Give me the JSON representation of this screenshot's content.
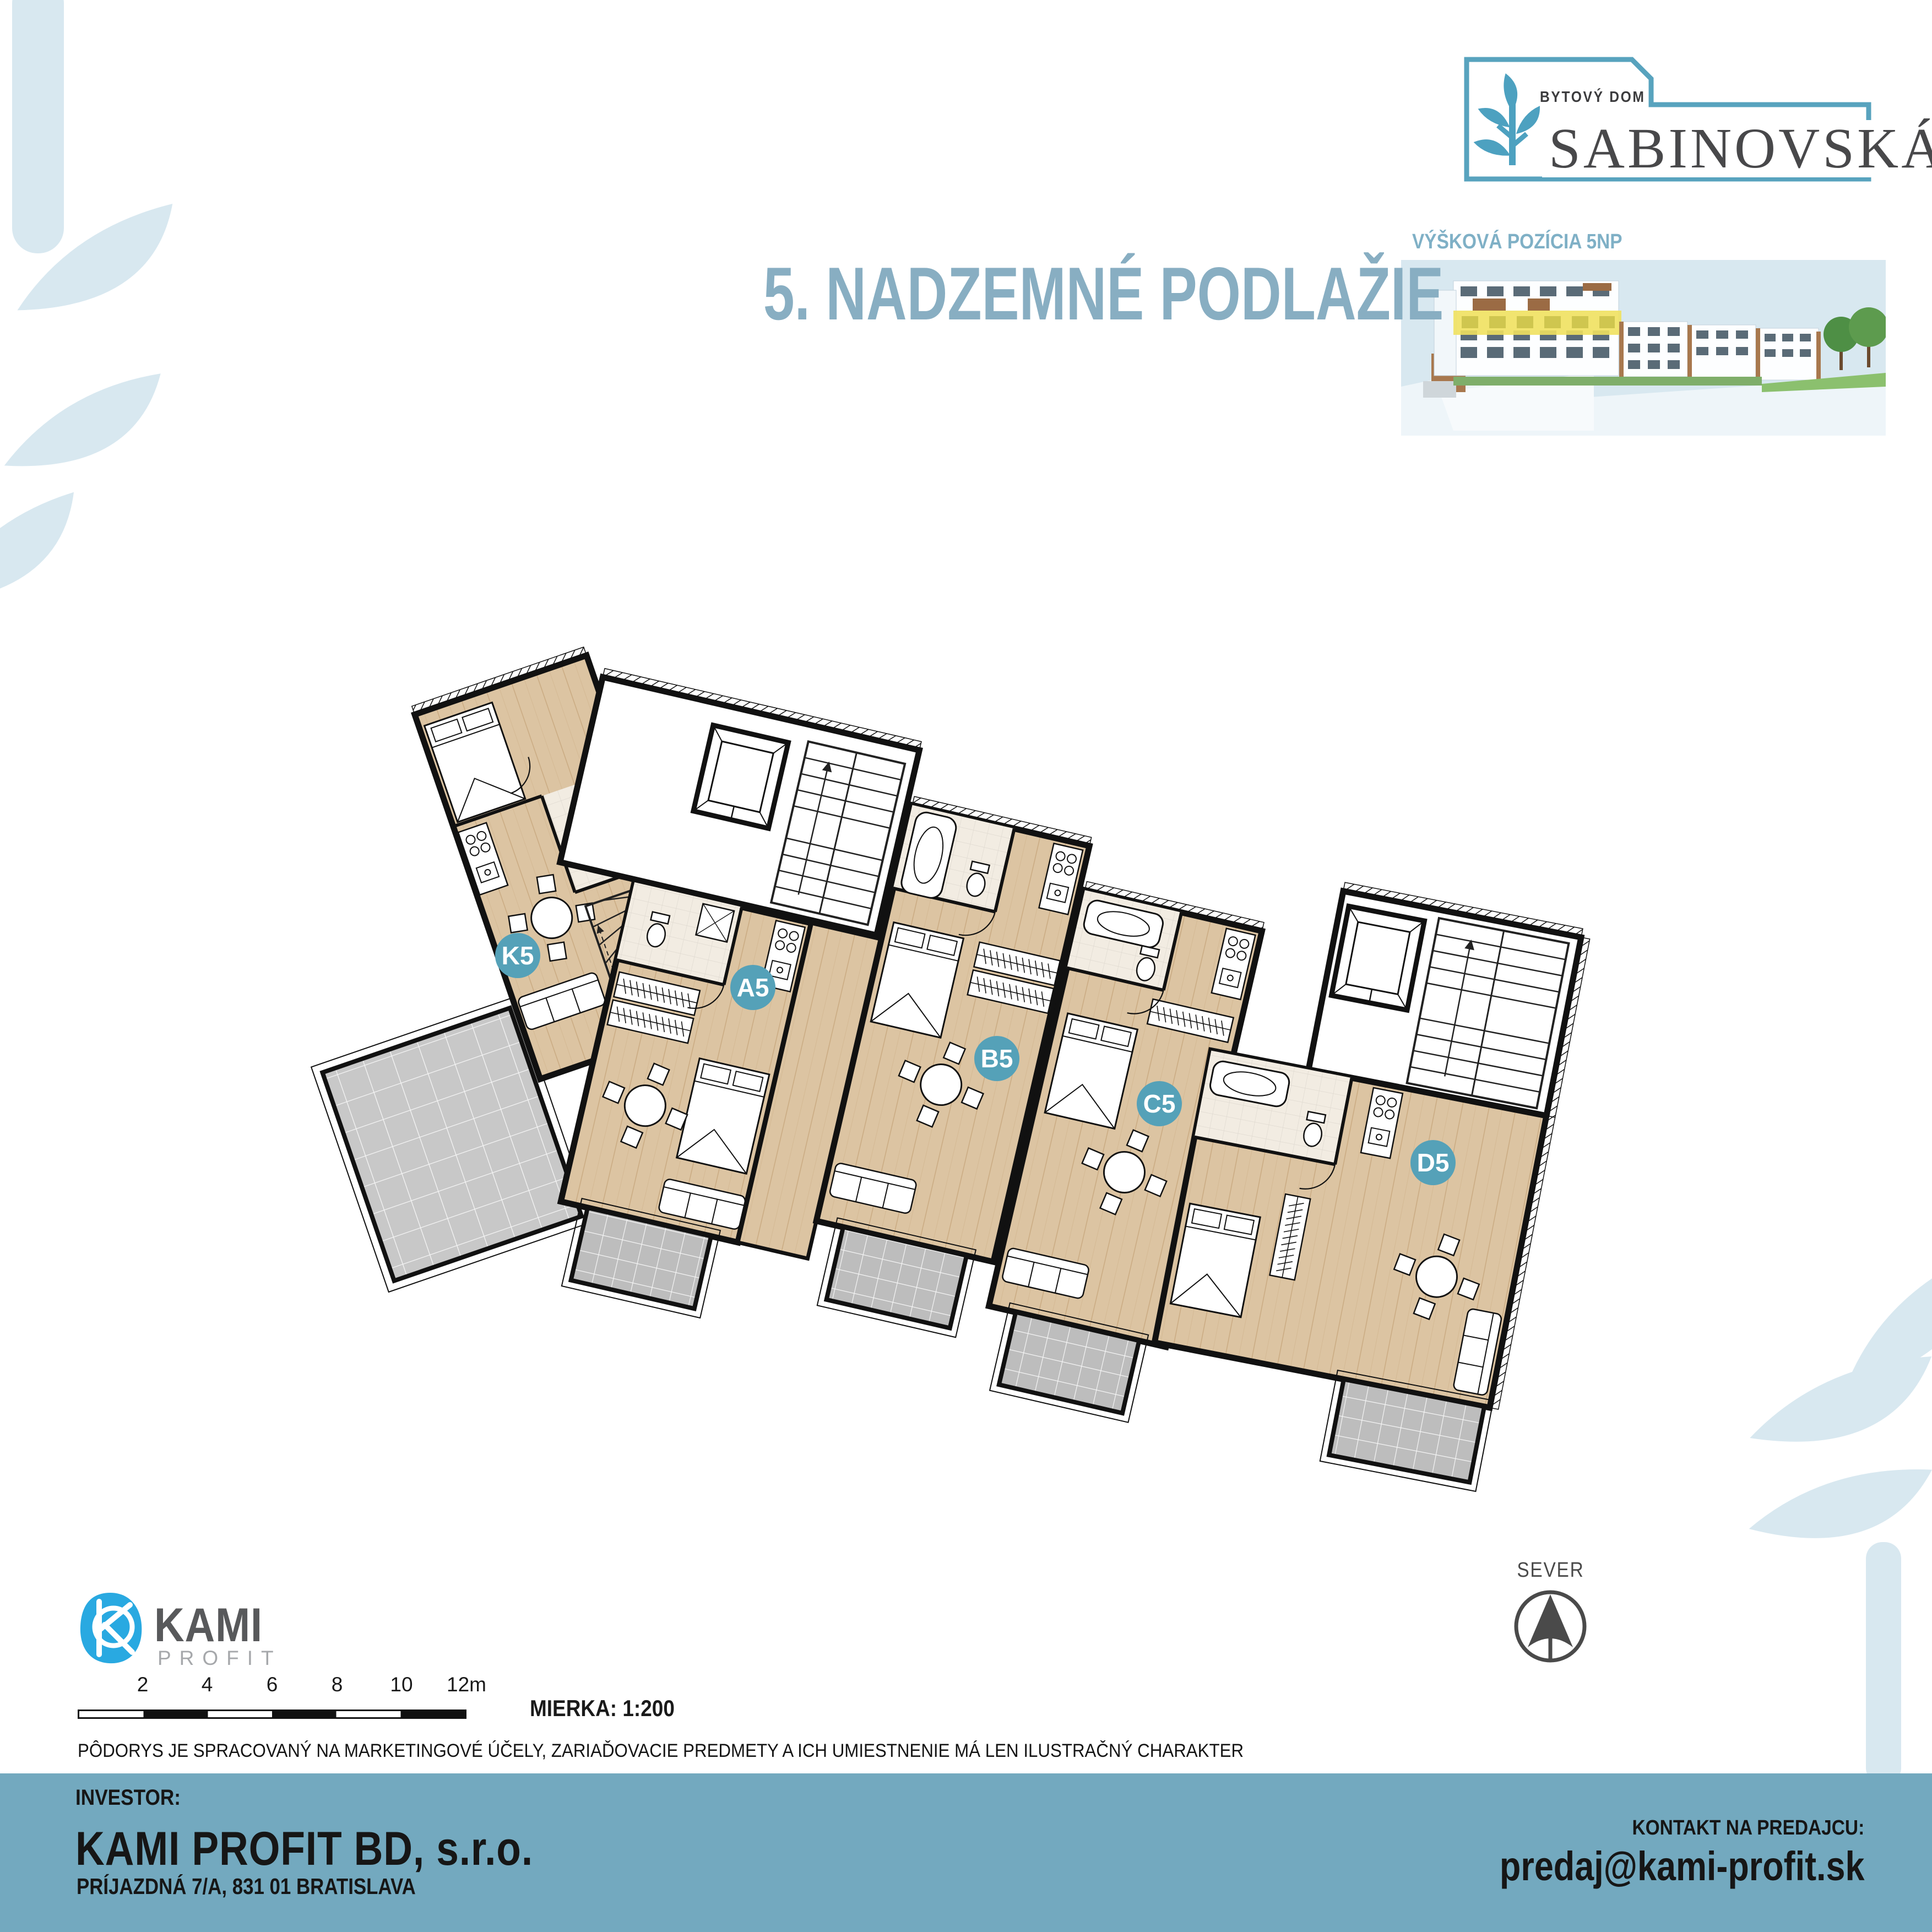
{
  "logo": {
    "brand_top": "BYTOVÝ DOM",
    "brand_name": "SABINOVSKÁ",
    "frame_color": "#58a3be",
    "tree_color": "#4da1c0",
    "text_color": "#48484a"
  },
  "elevation": {
    "label": "VÝŠKOVÁ POZÍCIA 5NP",
    "label_color": "#7fb0c6",
    "highlight_color": "#efe15f",
    "box_bg": "#d8e8f0"
  },
  "title": {
    "text": "5. NADZEMNÉ PODLAŽIE",
    "color": "#88aec2"
  },
  "plan": {
    "badge_color": "#55a1b8",
    "wood_color": "#dcc4a2",
    "balcony_color": "#bdbdbd",
    "apartments": [
      {
        "label": "K5"
      },
      {
        "label": "A5"
      },
      {
        "label": "B5"
      },
      {
        "label": "C5"
      },
      {
        "label": "D5"
      }
    ]
  },
  "north": {
    "label": "SEVER"
  },
  "scalebar": {
    "ticks": [
      "2",
      "4",
      "6",
      "8",
      "10",
      "12m"
    ],
    "scale_label": "MIERKA: 1:200"
  },
  "disclaimer": {
    "text": "PÔDORYS JE SPRACOVANÝ NA MARKETINGOVÉ ÚČELY, ZARIAĎOVACIE PREDMETY A ICH UMIESTNENIE MÁ LEN ILUSTRAČNÝ CHARAKTER"
  },
  "vendor_logo": {
    "name": "KAMI",
    "sub": "PROFIT",
    "blob_color": "#29a9e1"
  },
  "footer": {
    "bg": "#73a9bf",
    "investor_label": "INVESTOR:",
    "investor_name": "KAMI PROFIT BD, s.r.o.",
    "investor_address": "PRÍJAZDNÁ 7/A, 831 01 BRATISLAVA",
    "contact_label": "KONTAKT NA PREDAJCU:",
    "contact_email": "predaj@kami-profit.sk"
  }
}
